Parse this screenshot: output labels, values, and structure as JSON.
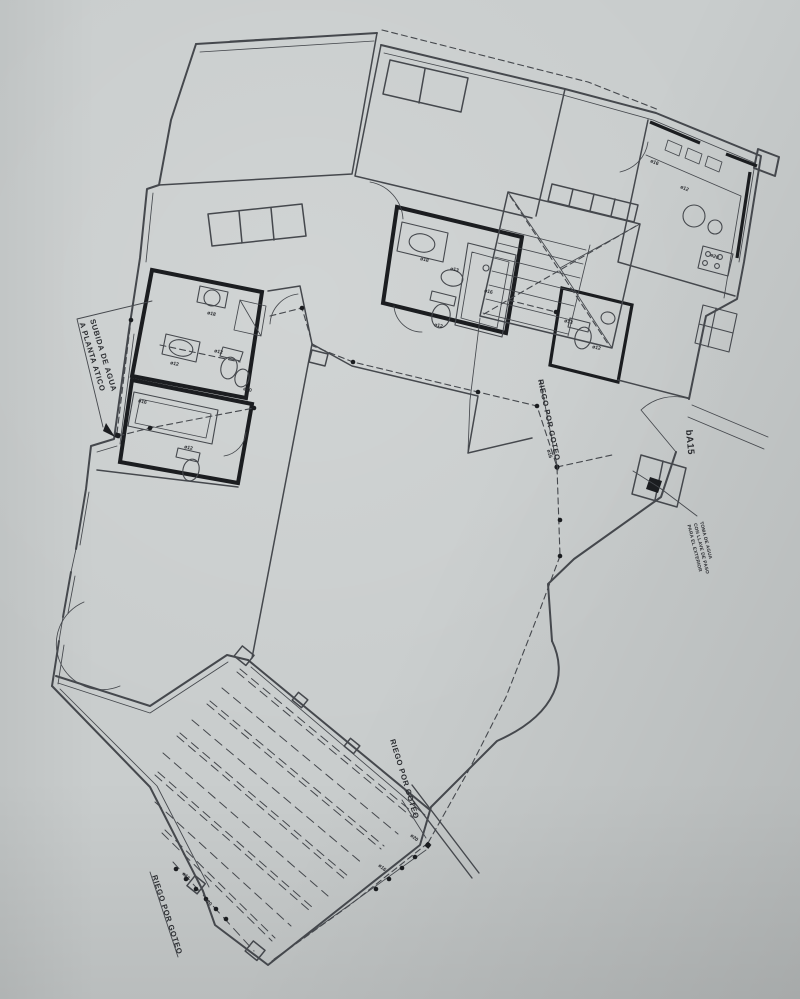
{
  "labels": {
    "subida_line1": "SUBIDA DE AGUA",
    "subida_line2": "A PLANTA ATICO",
    "riego_1": "RIEGO POR GOTEO",
    "riego_2": "RIEGO POR GOTEO",
    "riego_3": "RIEGO POR GOTEO",
    "door_code": "bA15",
    "note_line1": "TOMA DE AGUA",
    "note_line2": "CON LLAVE DE PASO",
    "note_line3": "PARA EL EXTERIOR"
  },
  "pipe_tags": [
    {
      "text": "ø18",
      "x": 207,
      "y": 314,
      "rot": 14
    },
    {
      "text": "ø12",
      "x": 170,
      "y": 364,
      "rot": 14
    },
    {
      "text": "ø12",
      "x": 214,
      "y": 352,
      "rot": 14
    },
    {
      "text": "ø10",
      "x": 243,
      "y": 390,
      "rot": 14
    },
    {
      "text": "ø16",
      "x": 138,
      "y": 402,
      "rot": 14
    },
    {
      "text": "ø12",
      "x": 184,
      "y": 448,
      "rot": 14
    },
    {
      "text": "ø18",
      "x": 420,
      "y": 260,
      "rot": 13
    },
    {
      "text": "ø13",
      "x": 450,
      "y": 270,
      "rot": 13
    },
    {
      "text": "ø12",
      "x": 434,
      "y": 326,
      "rot": 13
    },
    {
      "text": "ø16",
      "x": 484,
      "y": 292,
      "rot": 13
    },
    {
      "text": "ø13",
      "x": 564,
      "y": 322,
      "rot": 14
    },
    {
      "text": "ø12",
      "x": 592,
      "y": 348,
      "rot": 14
    },
    {
      "text": "ø16",
      "x": 650,
      "y": 162,
      "rot": 23
    },
    {
      "text": "ø12",
      "x": 680,
      "y": 188,
      "rot": 23
    },
    {
      "text": "ø20",
      "x": 710,
      "y": 256,
      "rot": 23
    },
    {
      "text": "ø16",
      "x": 547,
      "y": 450,
      "rot": 75
    },
    {
      "text": "ø20",
      "x": 410,
      "y": 836,
      "rot": 40
    },
    {
      "text": "ø16",
      "x": 378,
      "y": 866,
      "rot": 40
    },
    {
      "text": "ø16",
      "x": 182,
      "y": 874,
      "rot": 45
    },
    {
      "text": "ø20",
      "x": 204,
      "y": 900,
      "rot": 45
    }
  ],
  "colors": {
    "paper": "#c9cdcd",
    "line": "#45484d",
    "wall": "#1b1d20",
    "ink": "#2a2c30"
  }
}
